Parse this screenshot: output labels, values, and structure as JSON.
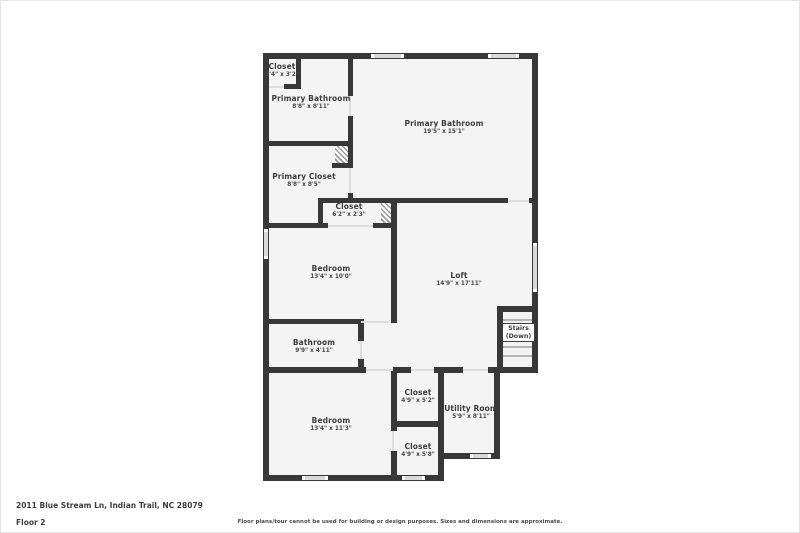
{
  "floorplan": {
    "rooms": [
      {
        "id": "closet-top",
        "name": "Closet",
        "dims": "3'4\" x 3'2\""
      },
      {
        "id": "primary-bathroom-sm",
        "name": "Primary Bathroom",
        "dims": "8'8\" x 8'11\""
      },
      {
        "id": "primary-bathroom-lg",
        "name": "Primary Bathroom",
        "dims": "19'5\" x 15'1\""
      },
      {
        "id": "primary-closet",
        "name": "Primary Closet",
        "dims": "8'8\" x 8'5\""
      },
      {
        "id": "closet-mid",
        "name": "Closet",
        "dims": "6'2\" x 2'3\""
      },
      {
        "id": "bedroom-mid",
        "name": "Bedroom",
        "dims": "13'4\" x 10'0\""
      },
      {
        "id": "loft",
        "name": "Loft",
        "dims": "14'9\" x 17'11\""
      },
      {
        "id": "bathroom",
        "name": "Bathroom",
        "dims": "9'9\" x 4'11\""
      },
      {
        "id": "bedroom-bottom",
        "name": "Bedroom",
        "dims": "13'4\" x 11'3\""
      },
      {
        "id": "closet-52",
        "name": "Closet",
        "dims": "4'9\" x 5'2\""
      },
      {
        "id": "utility-room",
        "name": "Utility Room",
        "dims": "5'9\" x 8'11\""
      },
      {
        "id": "closet-58",
        "name": "Closet",
        "dims": "4'9\" x 5'8\""
      }
    ],
    "stairs": {
      "line1": "Stairs",
      "line2": "(Down)"
    }
  },
  "footer": {
    "address": "2011 Blue Stream Ln, Indian Trail, NC 28079",
    "floor": "Floor 2",
    "disclaimer": "Floor plans/tour cannot be used for building or design purposes. Sizes and dimensions are approximate."
  },
  "colors": {
    "wall": "#383838",
    "room_fill": "#f4f4f4",
    "text": "#3d3d3d"
  }
}
